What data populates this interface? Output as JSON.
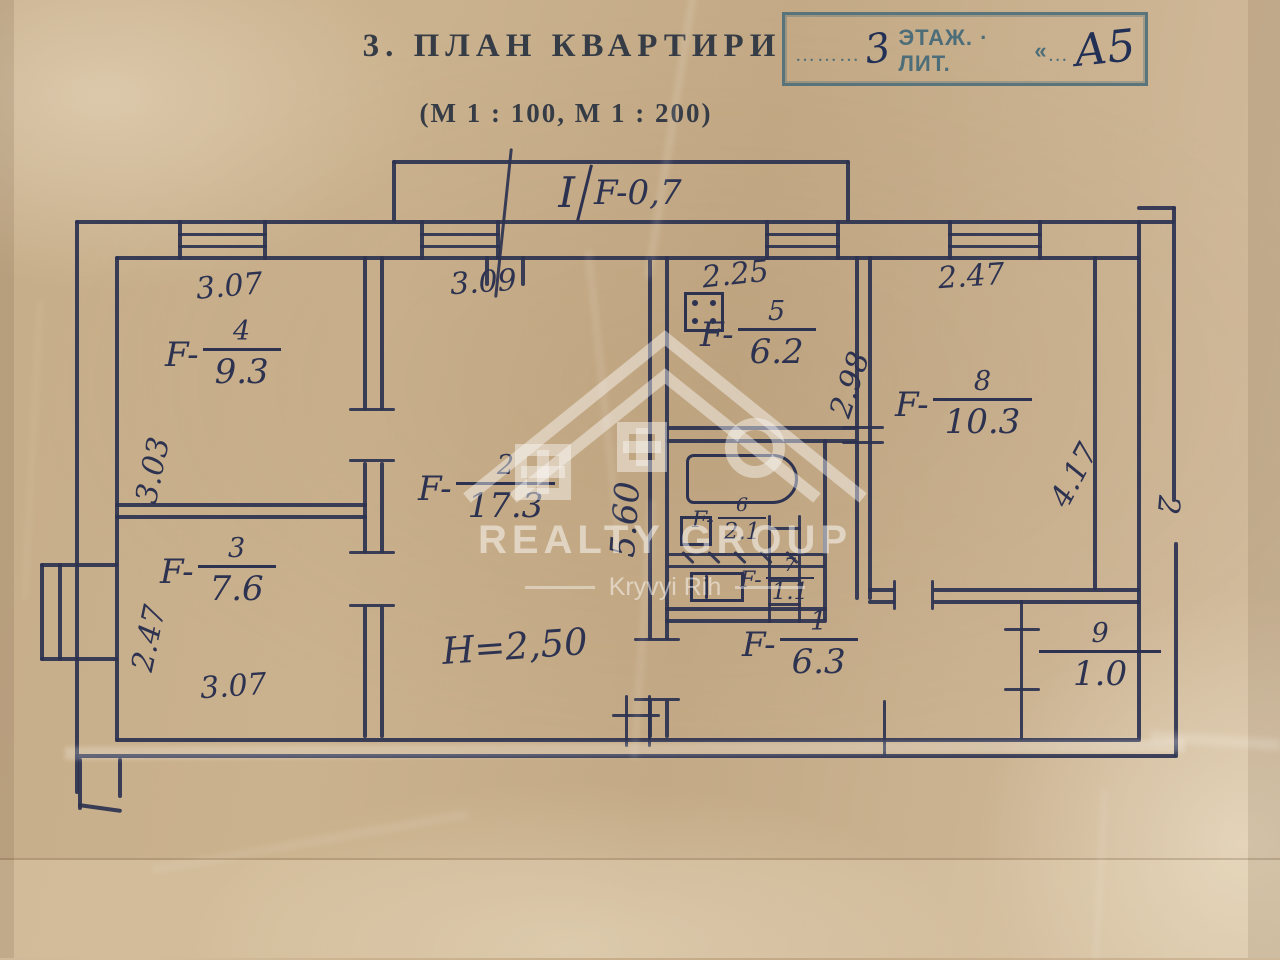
{
  "title": "3. ПЛАН КВАРТИРИ",
  "scale_note": "(М 1 : 100, М 1 : 200)",
  "stamp": {
    "dots_before": "………",
    "floor_value": "3",
    "label": "ЭТАЖ. · ЛИТ.",
    "quote": "«",
    "dots_mid": "…",
    "lit_value": "А5"
  },
  "balcony": {
    "roman": "I",
    "area": "F-0,7"
  },
  "height_note": "Н=2,50",
  "edge_mark": "2",
  "rooms": {
    "r1": {
      "number": "1",
      "prefix": "F-",
      "value": "6.3"
    },
    "r2": {
      "number": "2",
      "prefix": "F-",
      "value": "17.3"
    },
    "r3": {
      "number": "3",
      "prefix": "F-",
      "value": "7.6"
    },
    "r4": {
      "number": "4",
      "prefix": "F-",
      "value": "9.3"
    },
    "r5": {
      "number": "5",
      "prefix": "F-",
      "value": "6.2"
    },
    "r6": {
      "number": "6",
      "prefix": "F-",
      "value": "2.1"
    },
    "r7": {
      "number": "7",
      "prefix": "F-",
      "value": "1.1"
    },
    "r8": {
      "number": "8",
      "prefix": "F-",
      "value": "10.3"
    },
    "r9": {
      "number": "9",
      "prefix": "",
      "value": "1.0"
    }
  },
  "dims": {
    "r4_top": "3.07",
    "r4_left": "3.03",
    "r3_left": "2.47",
    "r3_bottom": "3.07",
    "r2_top": "3.09",
    "r2_right": "5.60",
    "r5_top": "2.25",
    "r5_right": "2.98",
    "r8_top": "2.47",
    "r8_right": "4.17"
  },
  "watermark": {
    "line1": "REALTY GROUP",
    "line2": "Kryvyi Rih"
  },
  "colors": {
    "ink": "#2c3250",
    "stamp": "#4d6e79",
    "paper": "#c2a884"
  }
}
